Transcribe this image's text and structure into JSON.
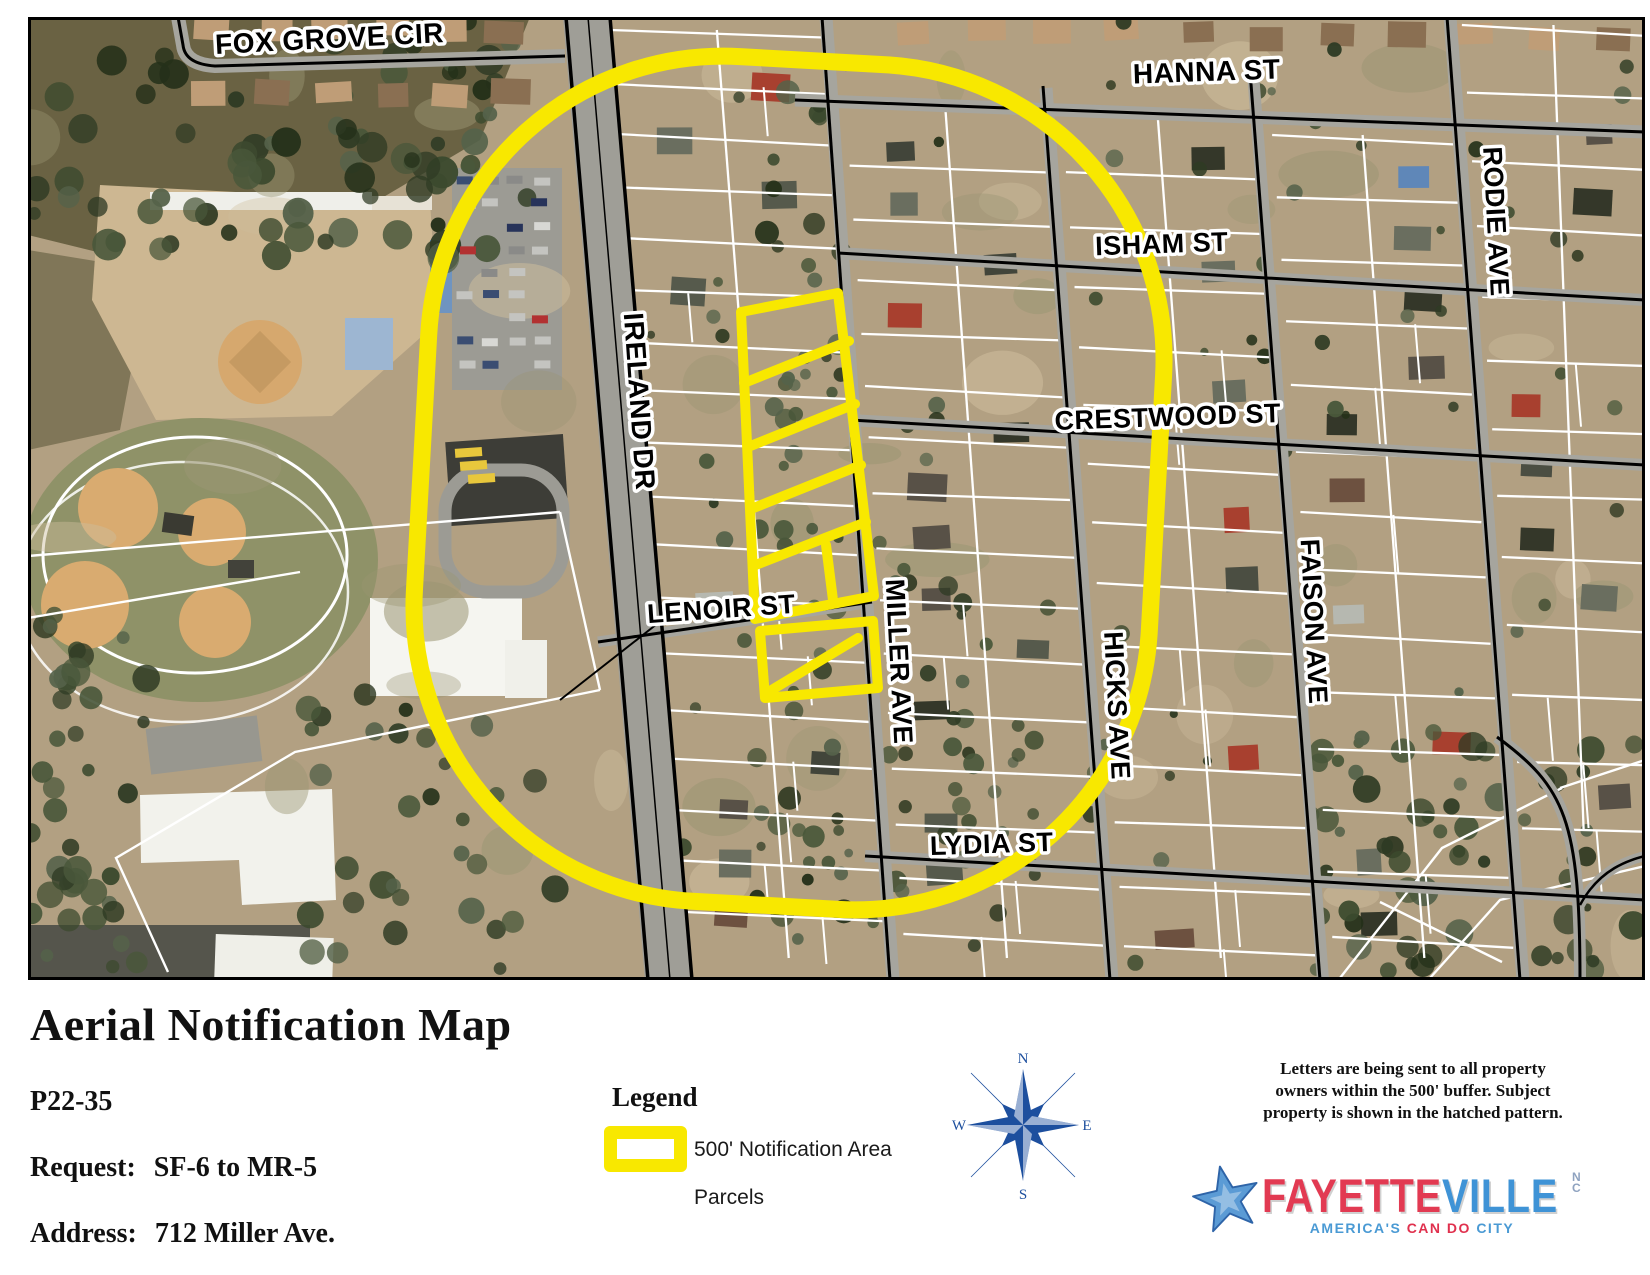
{
  "map": {
    "street_labels": [
      {
        "text": "FOX GROVE CIR",
        "x": 330,
        "y": 48,
        "rot": -3,
        "size": 28
      },
      {
        "text": "HANNA ST",
        "x": 1207,
        "y": 81,
        "rot": -2,
        "size": 28
      },
      {
        "text": "ISHAM ST",
        "x": 1162,
        "y": 253,
        "rot": -2,
        "size": 27
      },
      {
        "text": "CRESTWOOD ST",
        "x": 1168,
        "y": 426,
        "rot": -2,
        "size": 27
      },
      {
        "text": "LENOIR ST",
        "x": 722,
        "y": 618,
        "rot": -4,
        "size": 27
      },
      {
        "text": "LYDIA ST",
        "x": 992,
        "y": 853,
        "rot": -2,
        "size": 27
      },
      {
        "text": "IRELAND DR",
        "x": 630,
        "y": 402,
        "rot": 86,
        "size": 28
      },
      {
        "text": "MILLER AVE",
        "x": 890,
        "y": 662,
        "rot": 87,
        "size": 27
      },
      {
        "text": "HICKS AVE",
        "x": 1108,
        "y": 706,
        "rot": 87,
        "size": 27
      },
      {
        "text": "FAISON AVE",
        "x": 1305,
        "y": 622,
        "rot": 87,
        "size": 27
      },
      {
        "text": "RODIE AVE",
        "x": 1487,
        "y": 222,
        "rot": 87,
        "size": 27
      }
    ]
  },
  "footer": {
    "title": "Aerial Notification Map",
    "case_number": "P22-35",
    "request_label": "Request:",
    "request_value": "SF-6 to MR-5",
    "address_label": "Address:",
    "address_value": "712 Miller Ave.",
    "legend": {
      "heading": "Legend",
      "items": [
        {
          "label": "500' Notification Area"
        },
        {
          "label": "Parcels"
        }
      ]
    },
    "compass": {
      "n": "N",
      "s": "S",
      "e": "E",
      "w": "W"
    },
    "note_lines": [
      "Letters are being sent to all property",
      "owners within the 500' buffer.  Subject",
      "property is shown in the hatched pattern."
    ],
    "logo": {
      "city_part1": "FAYETTE",
      "city_part2": "VILLE",
      "state_line1": "N",
      "state_line2": "C",
      "tagline_part1": "AMERICA'S ",
      "tagline_part2": "CAN DO ",
      "tagline_part3": "CITY"
    }
  },
  "colors": {
    "buffer_yellow": "#F8E800",
    "parcel_line": "#FFFFFF",
    "street_line": "#000000",
    "compass_blue": "#1D4F9E",
    "logo_red": "#E23A52",
    "logo_blue": "#3F93D6",
    "logo_star_blue": "#5B9BD5",
    "tagline_blue": "#4A9AD4",
    "tagline_red": "#E0314E"
  }
}
